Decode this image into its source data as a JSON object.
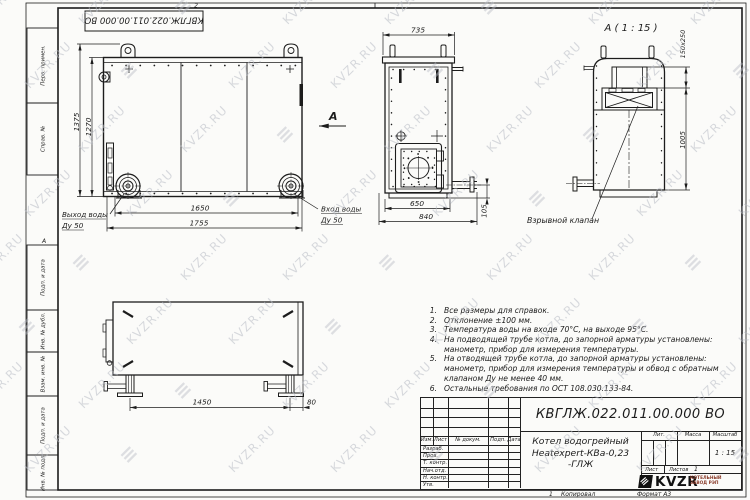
{
  "watermark": {
    "text": "KVZR.RU"
  },
  "frame": {
    "zone_top": "2",
    "zone_side": "А",
    "stamp_doc_number": "КВГЛЖ.022.011.00.000 ВО",
    "margin_fields": [
      "Перв. примен.",
      "Справ. №",
      "Подп. и дата",
      "Инв. № дубл.",
      "Взам. инв. №",
      "Подп. и дата",
      "Инв. № подл."
    ]
  },
  "views": {
    "front": {
      "dim_height_overall": "1375",
      "dim_height_body": "1270",
      "dim_width_flanges": "1650",
      "dim_width_overall": "1755",
      "outlet_label_1": "Выход воды",
      "outlet_label_2": "Ду 50",
      "inlet_label_1": "Вход воды",
      "inlet_label_2": "Ду 50",
      "view_letter": "А"
    },
    "side": {
      "dim_width_top": "735",
      "dim_width_body": "650",
      "dim_width_overall": "840",
      "dim_pipe_height": "105"
    },
    "detail_a": {
      "title": "А ( 1 : 15 )",
      "dim_flue": "150x250",
      "dim_height": "1005",
      "valve_label": "Взрывной клапан"
    },
    "bottom": {
      "dim_legs": "1450",
      "dim_offset": "80"
    }
  },
  "notes": {
    "lines": [
      {
        "num": "1.",
        "text": "Все размеры для справок."
      },
      {
        "num": "2.",
        "text": "Отклонение ±100 мм."
      },
      {
        "num": "3.",
        "text": "Температура воды на входе 70°С, на выходе 95°С."
      },
      {
        "num": "4.",
        "text": "На подводящей трубе котла, до запорной арматуры установлены:"
      },
      {
        "num": "",
        "text": "манометр, прибор для измерения температуры."
      },
      {
        "num": "5.",
        "text": "На отводящей трубе котла, до запорной арматуры установлены:"
      },
      {
        "num": "",
        "text": "манометр, прибор для измерения температуры и обвод с обратным"
      },
      {
        "num": "",
        "text": "клапаном Ду не менее 40 мм."
      },
      {
        "num": "6.",
        "text": "Остальные требования по ОСТ 108.030.133-84."
      }
    ]
  },
  "title_block": {
    "doc_number": "КВГЛЖ.022.011.00.000 ВО",
    "product_line1": "Котел водогрейный",
    "product_line2": "Heatexpert-КВа-0,23 -ГЛЖ",
    "col_izm": "Изм.",
    "col_list": "Лист",
    "col_doc": "№ докум.",
    "col_podp": "Подп.",
    "col_data": "Дата",
    "row_labels": [
      "Разраб.",
      "Пров.",
      "Т. контр.",
      "Нач.отд.",
      "Н. контр.",
      "Утв."
    ],
    "lit_label": "Лит.",
    "mass_label": "Масса",
    "scale_label": "Масштаб",
    "scale_value": "1 : 15",
    "sheet_label": "Лист",
    "sheets_label": "Листов",
    "sheets_value": "1",
    "logo_text": "KVZR",
    "logo_sub1": "КОТЕЛЬНЫЙ",
    "logo_sub2": "ЗАВОД РЭП",
    "footer_num": "1",
    "footer_copied": "Копировал",
    "footer_format": "Формат А3"
  },
  "colors": {
    "line": "#1c1c1c",
    "paper": "#fbfbf9",
    "watermark": "#b9bdc6",
    "logo_sub_text": "#8a3b2a"
  }
}
